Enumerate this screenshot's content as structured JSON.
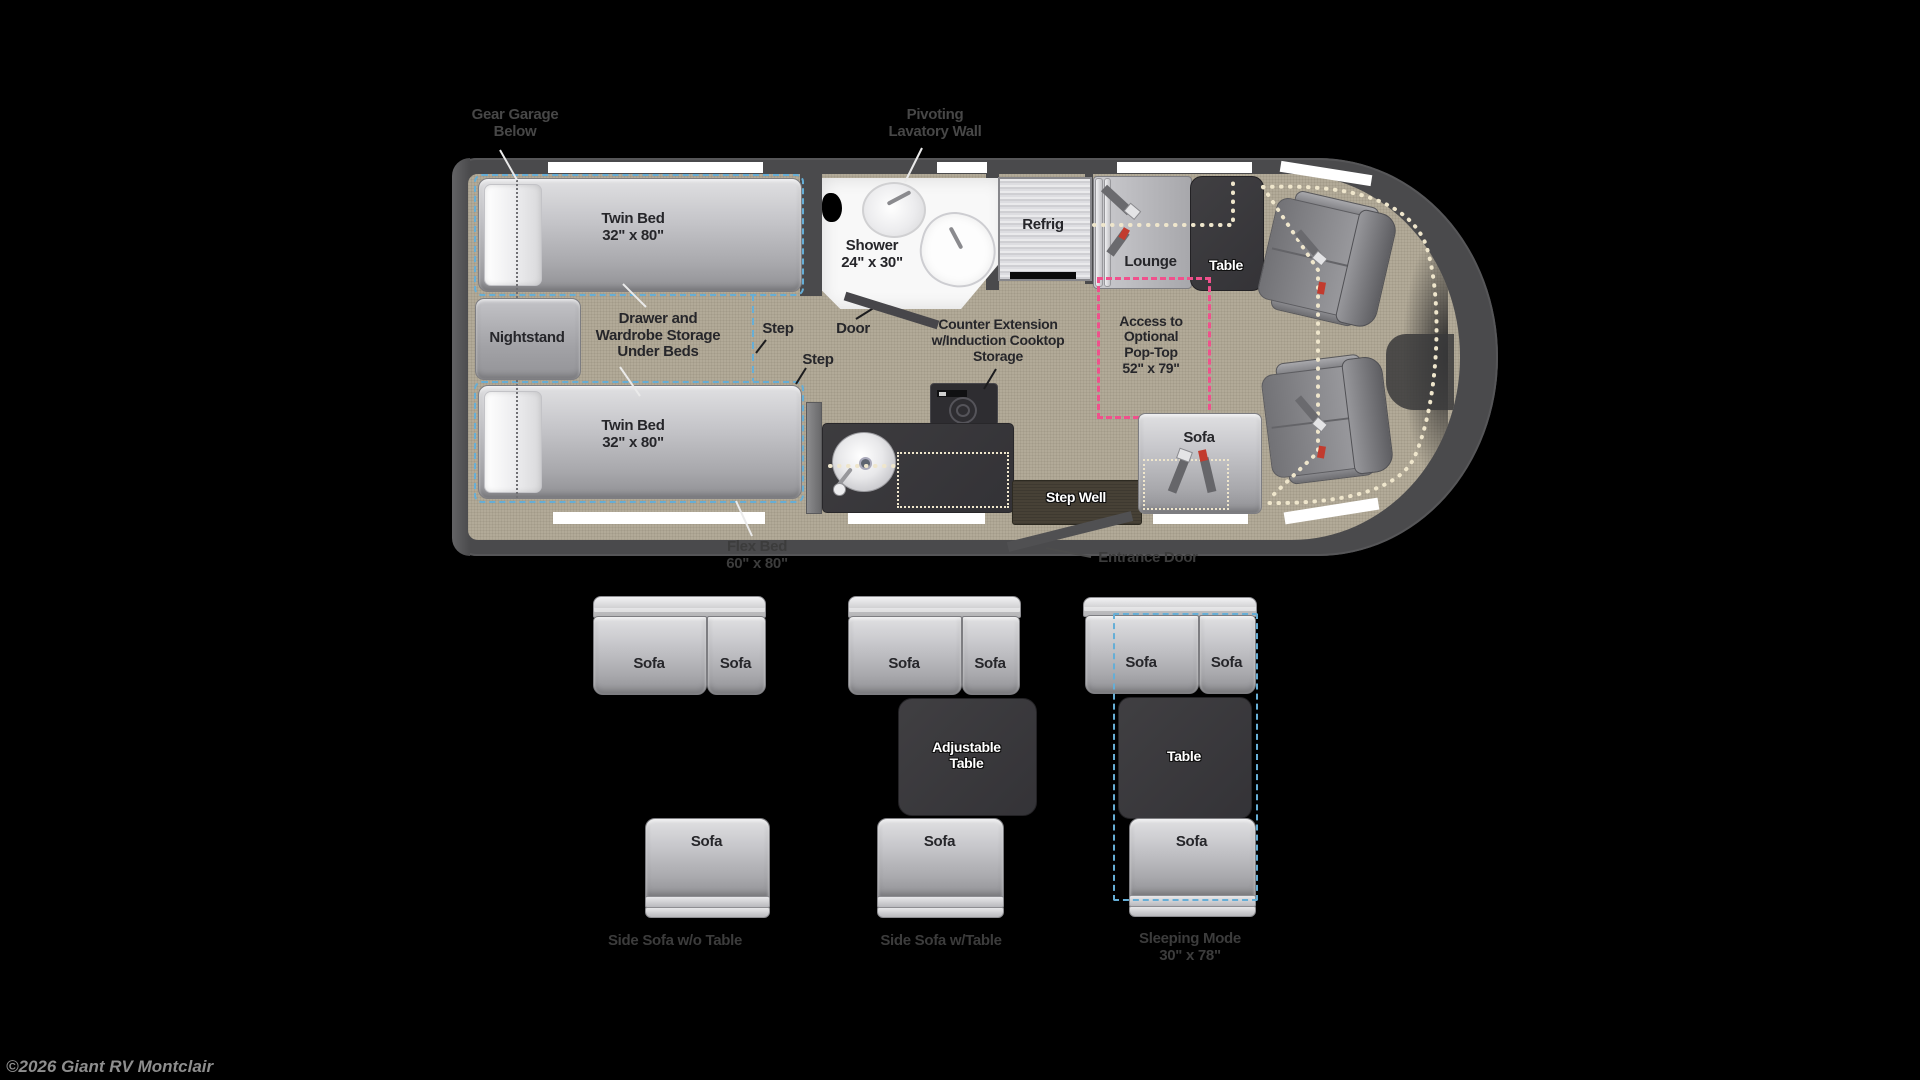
{
  "plan": {
    "gear_garage_1": "Gear Garage",
    "gear_garage_2": "Below",
    "lavatory_1": "Pivoting",
    "lavatory_2": "Lavatory Wall",
    "twin_bed_top_1": "Twin Bed",
    "twin_bed_top_2": "32\" x 80\"",
    "twin_bed_bottom_1": "Twin Bed",
    "twin_bed_bottom_2": "32\" x 80\"",
    "nightstand": "Nightstand",
    "storage_1": "Drawer and",
    "storage_2": "Wardrobe Storage",
    "storage_3": "Under Beds",
    "step_upper": "Step",
    "step_lower": "Step",
    "door": "Door",
    "shower_1": "Shower",
    "shower_2": "24\" x 30\"",
    "refrig": "Refrig",
    "lounge": "Lounge",
    "table": "Table",
    "counter_1": "Counter Extension",
    "counter_2": "w/Induction Cooktop",
    "counter_3": "Storage",
    "poptop_1": "Access to",
    "poptop_2": "Optional",
    "poptop_3": "Pop-Top",
    "poptop_4": "52\" x 79\"",
    "sofa": "Sofa",
    "step_well": "Step Well",
    "flex_bed_1": "Flex Bed",
    "flex_bed_2": "60\" x 80\"",
    "entrance_door": "Entrance Door"
  },
  "configs": {
    "side_sofa_no_table": {
      "sofa_left": "Sofa",
      "sofa_right": "Sofa",
      "sofa_bottom": "Sofa",
      "label": "Side Sofa w/o Table"
    },
    "side_sofa_with_table": {
      "sofa_left": "Sofa",
      "sofa_right": "Sofa",
      "table_1": "Adjustable",
      "table_2": "Table",
      "sofa_bottom": "Sofa",
      "label": "Side Sofa w/Table"
    },
    "sleeping_mode": {
      "sofa_left": "Sofa",
      "sofa_right": "Sofa",
      "table": "Table",
      "sofa_bottom": "Sofa",
      "label_1": "Sleeping Mode",
      "label_2": "30\" x 78\""
    }
  },
  "footer": {
    "copyright": "©2026 Giant RV Montclair"
  },
  "colors": {
    "flex_bed_outline": "#66aed6",
    "poptop_outline": "#f0508c",
    "poptop_trace": "#efe6cc",
    "seatbelt_accent": "#c23b2e",
    "floor": "#b2aa98",
    "body_wall": "#4a4a4c"
  }
}
